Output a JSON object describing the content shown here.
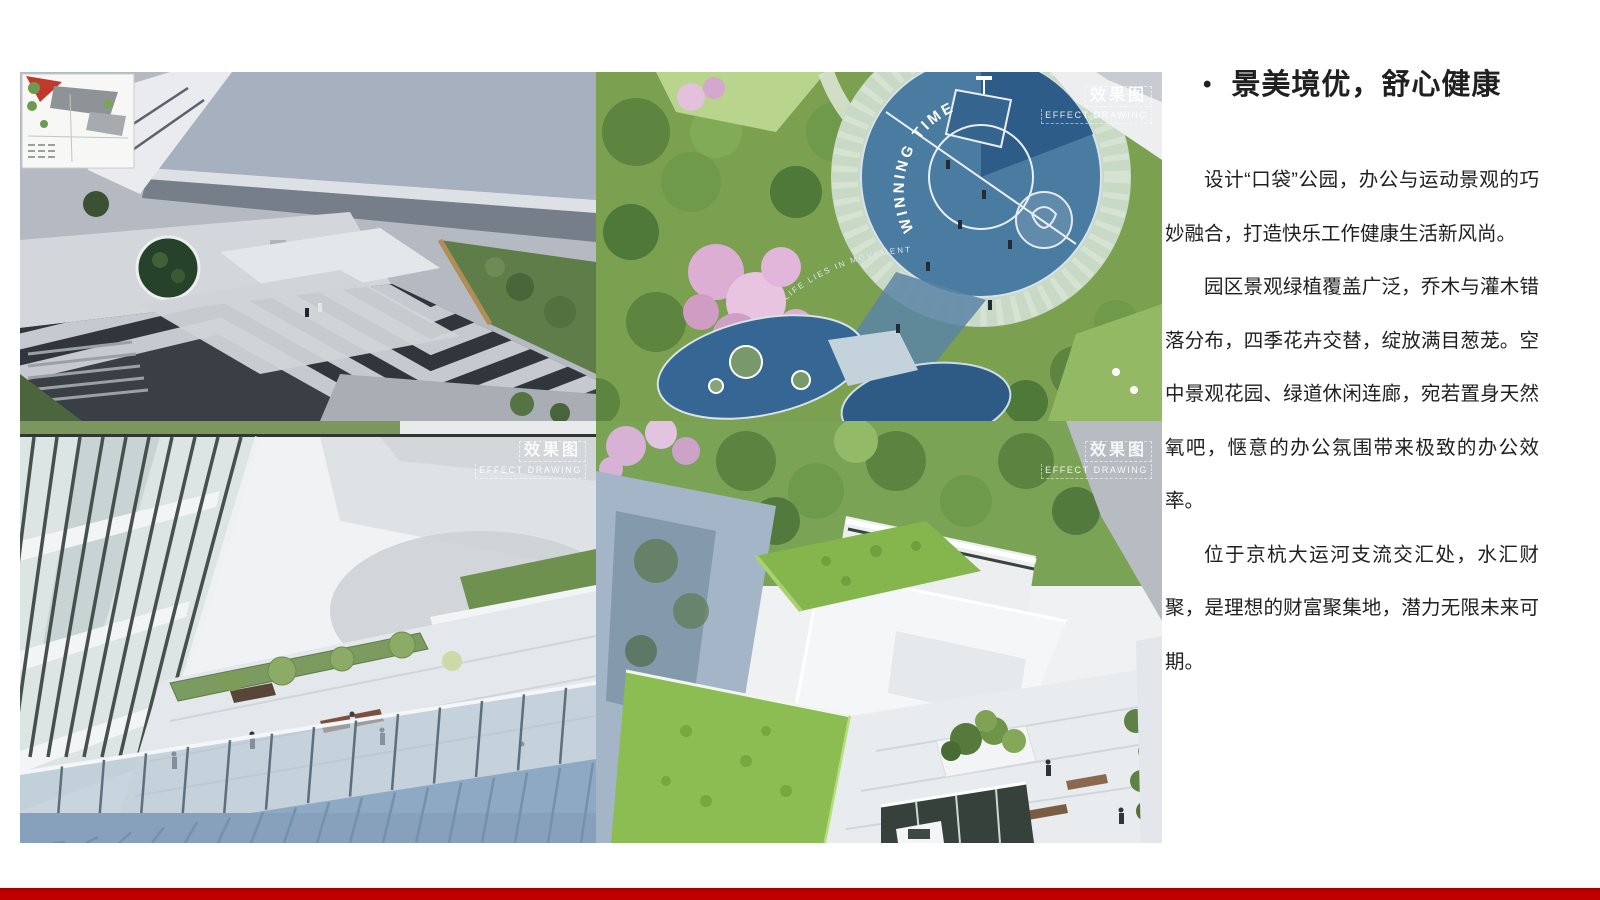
{
  "title_section": {
    "bullet": "•",
    "title": "景美境优，舒心健康"
  },
  "paragraphs": [
    "设计“口袋”公园，办公与运动景观的巧妙融合，打造快乐工作健康生活新风尚。",
    "园区景观绿植覆盖广泛，乔木与灌木错落分布，四季花卉交替，绽放满目葱茏。空中景观花园、绿道休闲连廊，宛若置身天然氧吧，惬意的办公氛围带来极致的办公效率。",
    "位于京杭大运河支流交汇处，水汇财聚，是理想的财富聚集地，潜力无限未来可期。"
  ],
  "watermark": {
    "cn": "效果图",
    "en": "EFFECT DRAWING"
  },
  "court_text": {
    "arc": "WINNING TIME",
    "sub": "LIFE LIES IN MOVEMENT"
  },
  "colors": {
    "accent_bar": "#c00000",
    "background": "#ffffff"
  }
}
